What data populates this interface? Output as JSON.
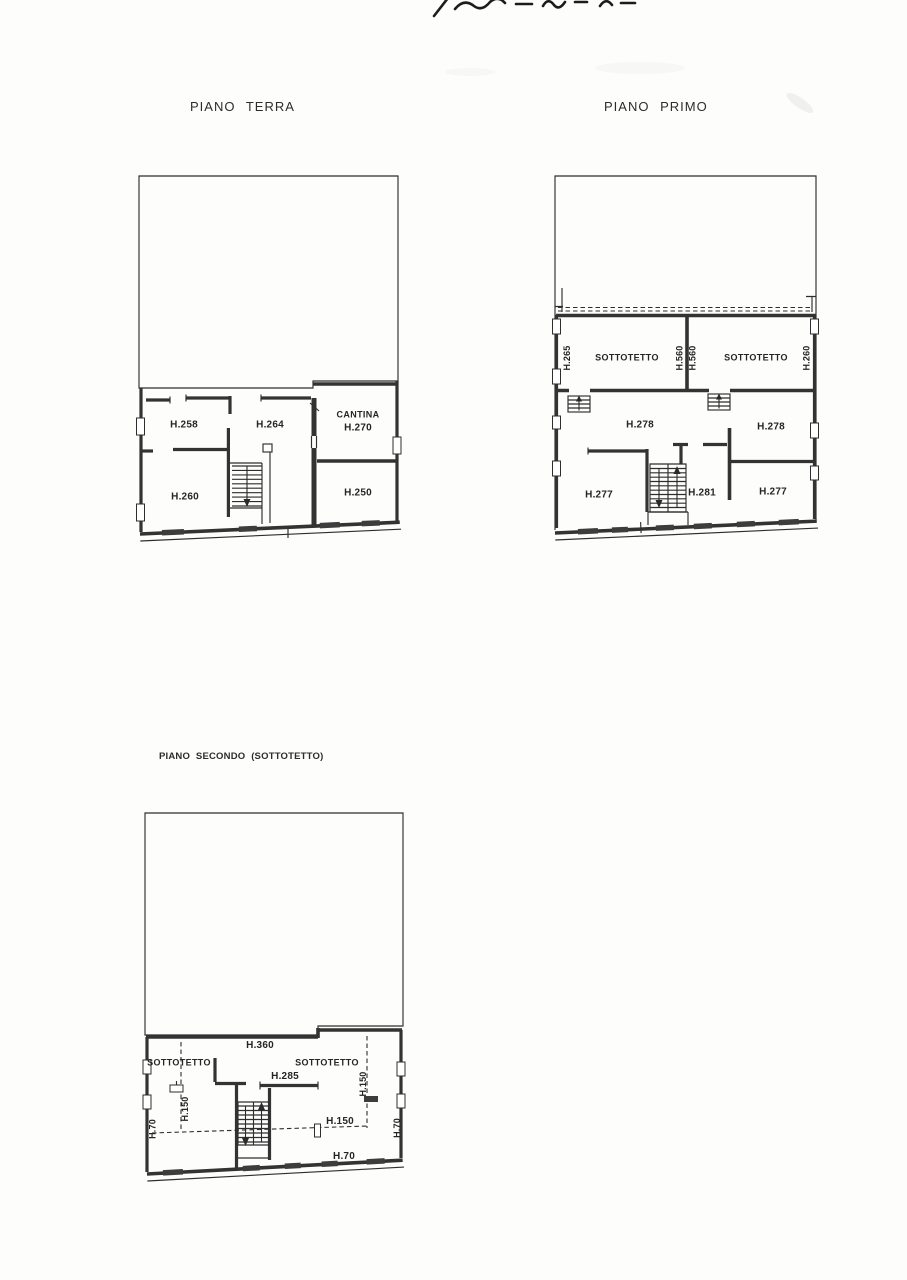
{
  "colors": {
    "ink": "#2e2e2e",
    "paper": "#fdfdfc"
  },
  "plans": {
    "terra": {
      "title": "PIANO TERRA",
      "labels": {
        "h258": "H.258",
        "h264": "H.264",
        "cantina": "CANTINA",
        "cantina_h": "H.270",
        "h260": "H.260",
        "h250": "H.250"
      }
    },
    "primo": {
      "title": "PIANO PRIMO",
      "labels": {
        "h265": "H.265",
        "sottotetto_left": "SOTTOTETTO",
        "h560_left": "H.560",
        "h560_right": "H.560",
        "sottotetto_right": "SOTTOTETTO",
        "h260": "H.260",
        "h278_left": "H.278",
        "h278_right": "H.278",
        "h277_left": "H.277",
        "h281": "H.281",
        "h277_right": "H.277"
      }
    },
    "secondo": {
      "title": "PIANO SECONDO (SOTTOTETTO)",
      "labels": {
        "h360": "H.360",
        "sottotetto_left": "SOTTOTETTO",
        "sottotetto_right": "SOTTOTETTO",
        "h285": "H.285",
        "h150_left": "H.150",
        "h150_right": "H.150",
        "h150_mid": "H.150",
        "h70_left": "H.70",
        "h70_right": "H.70",
        "h70_bottom": "H.70"
      }
    }
  }
}
